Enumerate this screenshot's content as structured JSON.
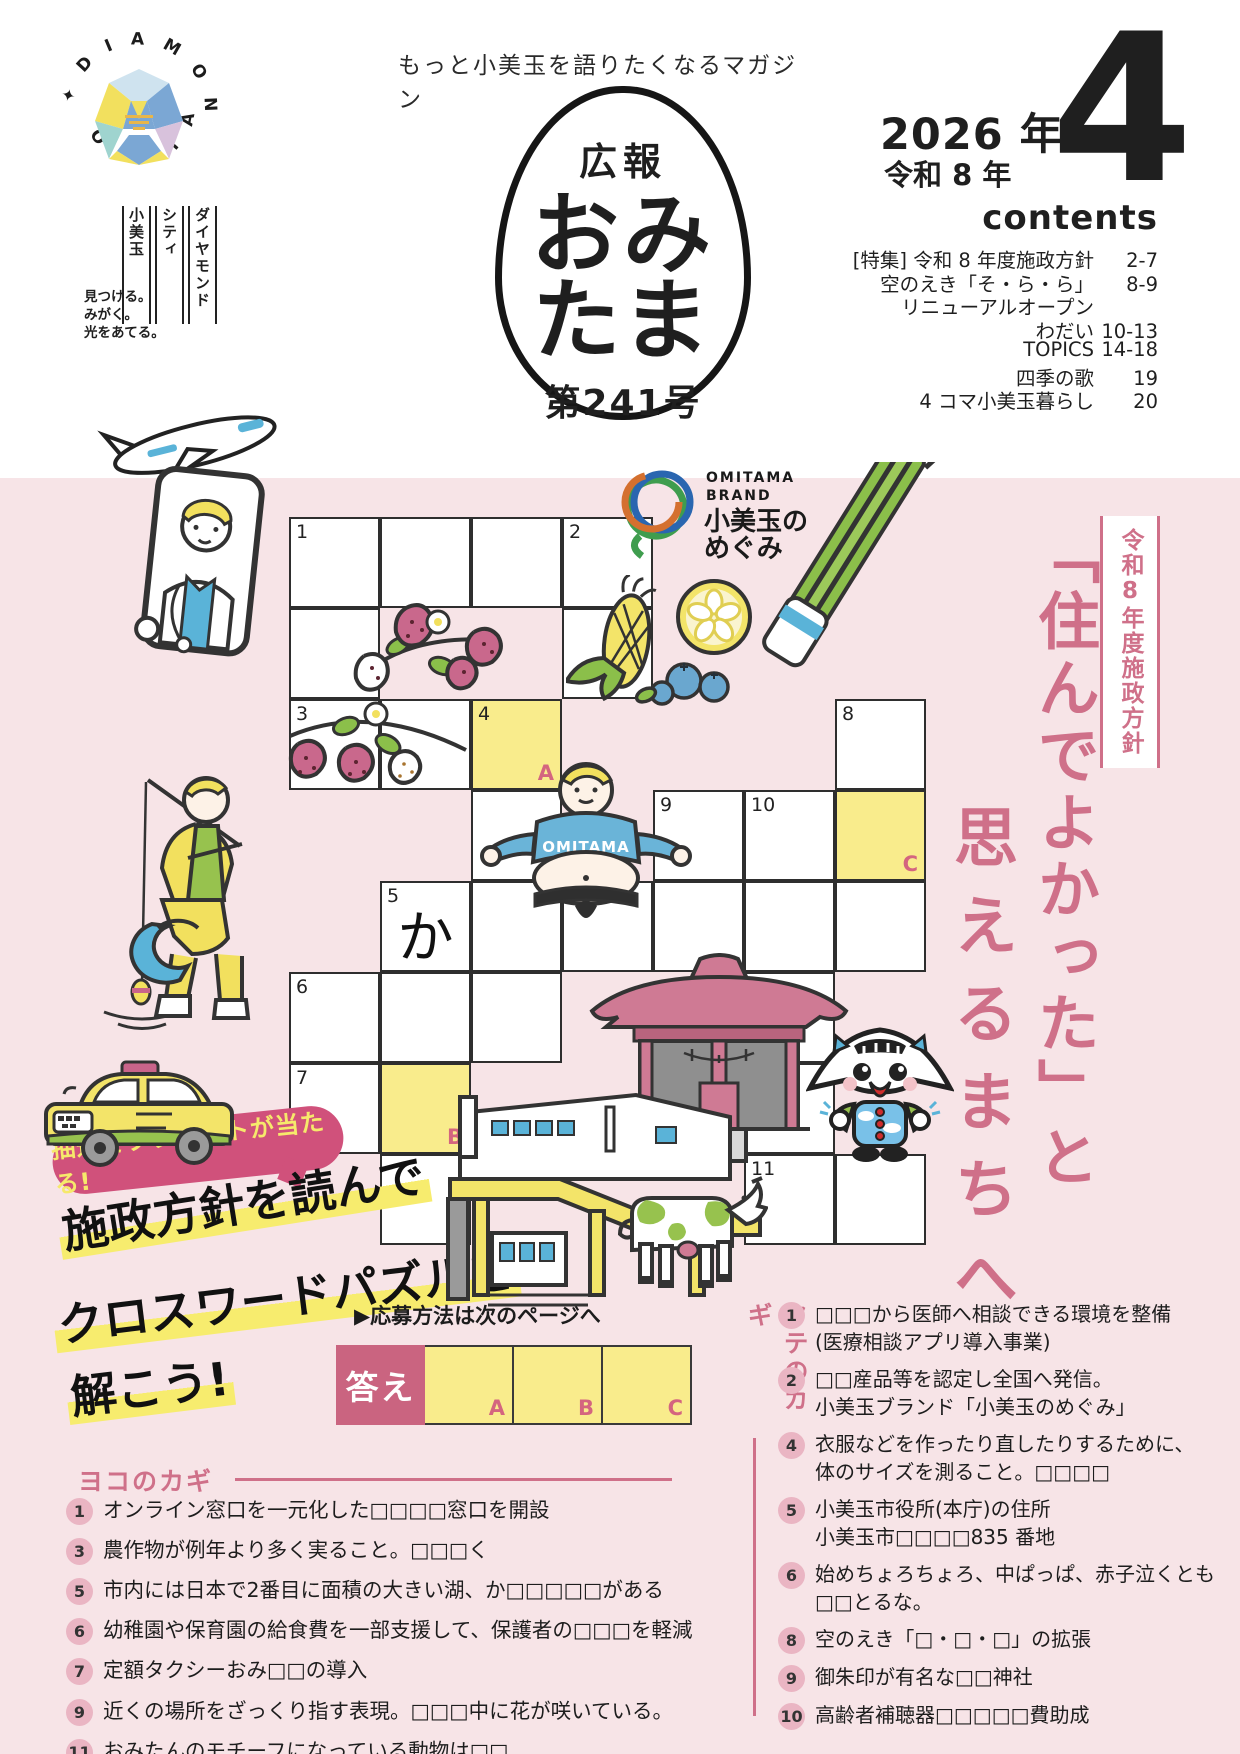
{
  "header": {
    "tagline": "もっと小美玉を語りたくなるマガジン",
    "city_logo": {
      "ring_top": "DIAMOND CITY",
      "ring_bottom": "OMITAMA",
      "vertical_names": [
        "ダイヤモンド",
        "シティ",
        "小美玉"
      ],
      "slogan_lines": [
        "見つける。",
        "みがく。",
        "光をあてる。"
      ]
    },
    "egg": {
      "kanji": "広報",
      "name_line1": "おみ",
      "name_line2": "たま",
      "issue": "第241号"
    },
    "date": {
      "year_western": "2026 年",
      "year_era": "令和 8 年",
      "month": "4"
    },
    "contents": {
      "title": "contents",
      "items": [
        {
          "label": "[特集] 令和 8 年度施政方針",
          "pages": "2-7"
        },
        {
          "label": "空のえき「そ・ら・ら」",
          "pages": "8-9"
        },
        {
          "label": "リニューアルオープン",
          "pages": ""
        },
        {
          "label": "わだい",
          "pages": "10-13"
        },
        {
          "label": "TOPICS",
          "pages": "14-18"
        },
        {
          "label": "四季の歌",
          "pages": "19"
        },
        {
          "label": "4 コマ小美玉暮らし",
          "pages": "20"
        }
      ]
    }
  },
  "hero": {
    "badge": "令和8年度施政方針",
    "headline_col_right": "「住んでよかった」と",
    "headline_col_left": "思えるまちへ",
    "brand_logo": {
      "en1": "OMITAMA",
      "en2": "BRAND",
      "jp1": "小美玉の",
      "jp2": "めぐみ"
    },
    "mascot_shirt": "OMITAMA"
  },
  "puzzle": {
    "promo": {
      "bubble": "抽選でプレゼントが当たる!",
      "brush1": "施政方針を読んで",
      "brush2": "クロスワードパズルを",
      "brush3": "解こう!",
      "apply_note": "▶応募方法は次のページへ"
    },
    "answer": {
      "label": "答え",
      "slots": [
        "A",
        "B",
        "C"
      ]
    },
    "grid": {
      "cols": 7,
      "rows": 8,
      "cell_px": 91,
      "origin_x": 289,
      "origin_y": 517,
      "prefilled_note": "か",
      "cells": [
        {
          "c": 1,
          "r": 1,
          "num": "1"
        },
        {
          "c": 2,
          "r": 1
        },
        {
          "c": 3,
          "r": 1
        },
        {
          "c": 4,
          "r": 1,
          "num": "2"
        },
        {
          "c": 1,
          "r": 2
        },
        {
          "c": 4,
          "r": 2
        },
        {
          "c": 1,
          "r": 3,
          "num": "3"
        },
        {
          "c": 2,
          "r": 3
        },
        {
          "c": 3,
          "r": 3,
          "num": "4",
          "yellow": true,
          "letter": "A"
        },
        {
          "c": 7,
          "r": 3,
          "num": "8"
        },
        {
          "c": 3,
          "r": 4
        },
        {
          "c": 5,
          "r": 4,
          "num": "9"
        },
        {
          "c": 6,
          "r": 4,
          "num": "10"
        },
        {
          "c": 7,
          "r": 4,
          "yellow": true,
          "letter": "C"
        },
        {
          "c": 2,
          "r": 5,
          "num": "5",
          "char": "か"
        },
        {
          "c": 3,
          "r": 5
        },
        {
          "c": 4,
          "r": 5
        },
        {
          "c": 5,
          "r": 5
        },
        {
          "c": 6,
          "r": 5
        },
        {
          "c": 7,
          "r": 5
        },
        {
          "c": 1,
          "r": 6,
          "num": "6"
        },
        {
          "c": 2,
          "r": 6
        },
        {
          "c": 3,
          "r": 6
        },
        {
          "c": 6,
          "r": 6
        },
        {
          "c": 1,
          "r": 7,
          "num": "7"
        },
        {
          "c": 2,
          "r": 7,
          "yellow": true,
          "letter": "B"
        },
        {
          "c": 6,
          "r": 7
        },
        {
          "c": 2,
          "r": 8
        },
        {
          "c": 6,
          "r": 8,
          "num": "11"
        },
        {
          "c": 7,
          "r": 8
        }
      ]
    },
    "across": {
      "title": "ヨコのカギ",
      "items": [
        {
          "num": "1",
          "text": "オンライン窓口を一元化した□□□□窓口を開設"
        },
        {
          "num": "3",
          "text": "農作物が例年より多く実ること。□□□く"
        },
        {
          "num": "5",
          "text": "市内には日本で2番目に面積の大きい湖、か□□□□□がある"
        },
        {
          "num": "6",
          "text": "幼稚園や保育園の給食費を一部支援して、保護者の□□□を軽減"
        },
        {
          "num": "7",
          "text": "定額タクシーおみ□□の導入"
        },
        {
          "num": "9",
          "text": "近くの場所をざっくり指す表現。□□□中に花が咲いている。"
        },
        {
          "num": "11",
          "text": "おみたんのモチーフになっている動物は□□"
        }
      ]
    },
    "down": {
      "title": "タテのカギ",
      "items": [
        {
          "num": "1",
          "line1": "□□□から医師へ相談できる環境を整備",
          "line2": "(医療相談アプリ導入事業)"
        },
        {
          "num": "2",
          "line1": "□□産品等を認定し全国へ発信。",
          "line2": "小美玉ブランド「小美玉のめぐみ」"
        },
        {
          "num": "4",
          "line1": "衣服などを作ったり直したりするために、",
          "line2": "体のサイズを測ること。□□□□"
        },
        {
          "num": "5",
          "line1": "小美玉市役所(本庁)の住所",
          "line2": "小美玉市□□□□835 番地"
        },
        {
          "num": "6",
          "line1": "始めちょろちょろ、中ぱっぱ、赤子泣くとも",
          "line2": "□□とるな。"
        },
        {
          "num": "8",
          "line1": "空のえき「□・□・□」の拡張",
          "line2": ""
        },
        {
          "num": "9",
          "line1": "御朱印が有名な□□神社",
          "line2": ""
        },
        {
          "num": "10",
          "line1": "高齢者補聴器□□□□□費助成",
          "line2": ""
        }
      ]
    }
  },
  "colors": {
    "page_pink": "#f7e4e7",
    "cell_yellow": "#f9ec8c",
    "accent_pink": "#cf7089",
    "answer_box": "#ca6480",
    "bubble_pink": "#d0517b",
    "highlight_yellow": "#f7ec6e"
  }
}
